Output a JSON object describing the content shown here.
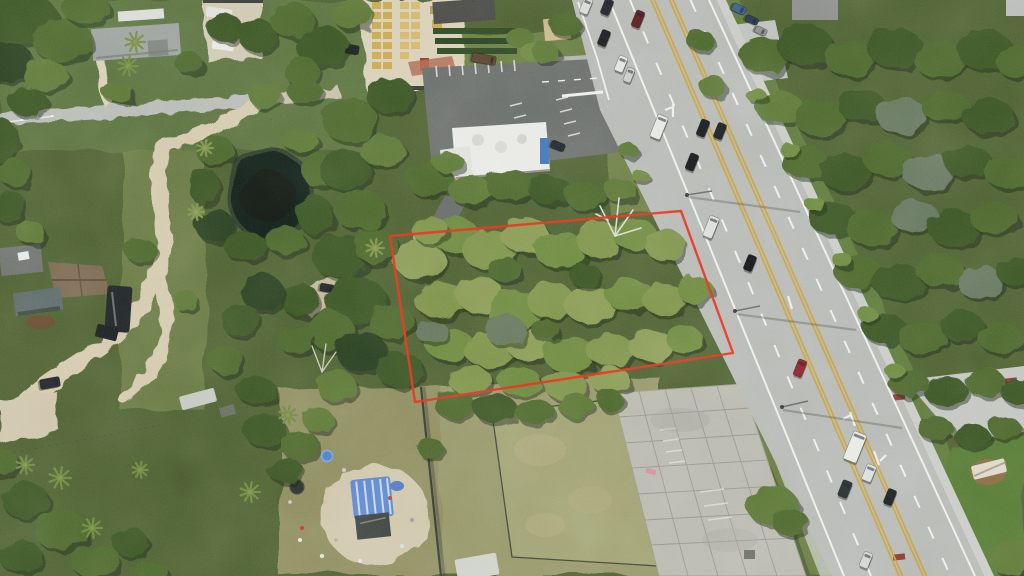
{
  "scene": {
    "description": "Aerial drone photograph of a vacant wooded parcel outlined in red, bordered by a five-lane highway on the east, a pond and rural homes to the west, a commercial parking lot to the north and an old concrete pad to the south",
    "boundary": {
      "points": "390,236 681,211 733,353 415,402",
      "color": "#e8301d",
      "width": 2.4
    },
    "colors": {
      "tree_shades": [
        "#2c4120",
        "#3c5628",
        "#4d682f",
        "#5d7837",
        "#6e8a41",
        "#7e944b",
        "#8a9b55",
        "#66775e"
      ],
      "tree_shadow": "#1b2913",
      "base_forest": "#4f6233",
      "lawn": "#5c7340",
      "lawn_right": "#5e7a3c",
      "lawn_corner": "#567a36",
      "field": "#8f8d60",
      "field_east": "#97976a",
      "mowed_yard": "#a0a273",
      "dirt": "#d3c9ad",
      "sand": "#d8cfb6",
      "gravel": "#cfc9b2",
      "pond": "#19241d",
      "pond_bank": "#31402f",
      "road_asphalt": "#b7b9b5",
      "curb_concrete": "#c9cbc6",
      "lot_asphalt": "#6a6e6b",
      "concrete_pad": "#b9b9af",
      "marking_white": "#eceee9",
      "marking_yellow": "#c8a23c",
      "tarp_blue": "#5a86cf",
      "roof_gray": "#9aa09c",
      "roof_brown": "#7a6850",
      "roof_white": "#e8e9e4"
    },
    "vehicles": [
      [
        586,
        6,
        16,
        9,
        "#d8dad6"
      ],
      [
        607,
        7,
        16,
        9,
        "#23262a"
      ],
      [
        638,
        19,
        17,
        9,
        "#5d2026"
      ],
      [
        604,
        38,
        16,
        9,
        "#1e2124"
      ],
      [
        621,
        64,
        16,
        9,
        "#e2e4e0"
      ],
      [
        629,
        75,
        15,
        8,
        "#c9cbc7"
      ],
      [
        659,
        127,
        24,
        11,
        "#e6e7e3"
      ],
      [
        703,
        128,
        17,
        9,
        "#1b1e21"
      ],
      [
        720,
        131,
        16,
        9,
        "#202327"
      ],
      [
        692,
        162,
        17,
        9,
        "#191c1f"
      ],
      [
        711,
        227,
        22,
        10,
        "#dcdeda"
      ],
      [
        750,
        263,
        16,
        9,
        "#17191c"
      ],
      [
        800,
        368,
        17,
        9,
        "#8e2328"
      ],
      [
        855,
        447,
        30,
        14,
        "#e8e9e5"
      ],
      [
        869,
        473,
        17,
        10,
        "#dcdeda"
      ],
      [
        845,
        489,
        17,
        10,
        "#2a2e31"
      ],
      [
        890,
        497,
        16,
        9,
        "#1d2023"
      ],
      [
        866,
        560,
        16,
        9,
        "#d2d4d0"
      ],
      [
        739,
        9,
        14,
        8,
        "#3e5d8f",
        115
      ],
      [
        752,
        20,
        13,
        7,
        "#2c3a55",
        115
      ],
      [
        761,
        31,
        12,
        7,
        "#8e9290",
        115
      ],
      [
        350,
        49,
        18,
        9,
        "#20241f",
        100
      ],
      [
        484,
        59,
        24,
        9,
        "#5c4632",
        100
      ],
      [
        558,
        146,
        14,
        8,
        "#20262e",
        112
      ],
      [
        50,
        383,
        20,
        10,
        "#23282b",
        80
      ],
      [
        327,
        288,
        14,
        8,
        "#23282b",
        100
      ],
      [
        331,
        316,
        16,
        6,
        "#b9c0bd",
        75
      ]
    ],
    "trees": [
      [
        20,
        18,
        38,
        26,
        1
      ],
      [
        62,
        40,
        30,
        22,
        2
      ],
      [
        8,
        62,
        26,
        20,
        0
      ],
      [
        46,
        76,
        22,
        16,
        3
      ],
      [
        86,
        8,
        24,
        16,
        2
      ],
      [
        28,
        102,
        20,
        14,
        1
      ],
      [
        0,
        140,
        18,
        22,
        1
      ],
      [
        14,
        172,
        16,
        14,
        2
      ],
      [
        8,
        206,
        18,
        16,
        1
      ],
      [
        30,
        232,
        14,
        12,
        3
      ],
      [
        118,
        92,
        16,
        10,
        3
      ],
      [
        188,
        62,
        14,
        10,
        2
      ],
      [
        225,
        28,
        18,
        14,
        1
      ],
      [
        258,
        36,
        20,
        16,
        1
      ],
      [
        292,
        20,
        22,
        18,
        2
      ],
      [
        322,
        46,
        26,
        20,
        1
      ],
      [
        352,
        14,
        20,
        16,
        3
      ],
      [
        302,
        72,
        18,
        14,
        2
      ],
      [
        265,
        96,
        16,
        12,
        3
      ],
      [
        305,
        92,
        18,
        12,
        2
      ],
      [
        565,
        25,
        16,
        12,
        2
      ],
      [
        545,
        52,
        14,
        10,
        3
      ],
      [
        215,
        150,
        20,
        14,
        2
      ],
      [
        204,
        186,
        16,
        18,
        1
      ],
      [
        215,
        226,
        20,
        16,
        0
      ],
      [
        245,
        246,
        22,
        14,
        1
      ],
      [
        285,
        240,
        20,
        14,
        2
      ],
      [
        315,
        215,
        18,
        20,
        1
      ],
      [
        318,
        170,
        16,
        18,
        2
      ],
      [
        300,
        140,
        18,
        12,
        3
      ],
      [
        350,
        120,
        28,
        22,
        2
      ],
      [
        390,
        95,
        24,
        18,
        1
      ],
      [
        345,
        170,
        26,
        20,
        1
      ],
      [
        382,
        150,
        22,
        16,
        3
      ],
      [
        360,
        210,
        26,
        20,
        2
      ],
      [
        340,
        256,
        28,
        22,
        1
      ],
      [
        376,
        246,
        22,
        18,
        2
      ],
      [
        356,
        300,
        30,
        24,
        1
      ],
      [
        330,
        330,
        24,
        20,
        2
      ],
      [
        362,
        352,
        26,
        20,
        0
      ],
      [
        392,
        322,
        22,
        18,
        2
      ],
      [
        400,
        370,
        24,
        18,
        1
      ],
      [
        336,
        386,
        20,
        16,
        3
      ],
      [
        300,
        300,
        20,
        16,
        1
      ],
      [
        296,
        340,
        18,
        14,
        2
      ],
      [
        262,
        292,
        22,
        18,
        0
      ],
      [
        240,
        320,
        20,
        16,
        1
      ],
      [
        226,
        360,
        18,
        14,
        2
      ],
      [
        256,
        390,
        20,
        14,
        1
      ],
      [
        140,
        250,
        16,
        12,
        2
      ],
      [
        185,
        300,
        12,
        10,
        3
      ],
      [
        430,
        180,
        24,
        16,
        2
      ],
      [
        470,
        190,
        22,
        14,
        3
      ],
      [
        510,
        185,
        24,
        16,
        2
      ],
      [
        550,
        190,
        22,
        14,
        1
      ],
      [
        585,
        196,
        20,
        14,
        2
      ],
      [
        620,
        190,
        16,
        12,
        3
      ],
      [
        448,
        162,
        16,
        10,
        3
      ],
      [
        420,
        260,
        26,
        20,
        6
      ],
      [
        455,
        235,
        24,
        18,
        4
      ],
      [
        490,
        250,
        28,
        20,
        5
      ],
      [
        525,
        235,
        24,
        18,
        6
      ],
      [
        560,
        250,
        26,
        18,
        4
      ],
      [
        600,
        240,
        24,
        18,
        5
      ],
      [
        635,
        235,
        22,
        16,
        4
      ],
      [
        665,
        245,
        20,
        16,
        5
      ],
      [
        430,
        230,
        18,
        14,
        5
      ],
      [
        440,
        300,
        26,
        18,
        5
      ],
      [
        480,
        295,
        24,
        18,
        6
      ],
      [
        515,
        310,
        28,
        20,
        4
      ],
      [
        550,
        300,
        24,
        18,
        5
      ],
      [
        590,
        305,
        26,
        18,
        6
      ],
      [
        630,
        295,
        24,
        16,
        4
      ],
      [
        665,
        300,
        22,
        16,
        5
      ],
      [
        695,
        290,
        18,
        14,
        4
      ],
      [
        450,
        345,
        24,
        16,
        4
      ],
      [
        490,
        350,
        26,
        18,
        5
      ],
      [
        530,
        345,
        24,
        16,
        6
      ],
      [
        570,
        355,
        26,
        18,
        4
      ],
      [
        610,
        350,
        24,
        16,
        5
      ],
      [
        650,
        345,
        22,
        16,
        6
      ],
      [
        685,
        340,
        18,
        14,
        4
      ],
      [
        470,
        380,
        22,
        14,
        5
      ],
      [
        520,
        382,
        22,
        14,
        4
      ],
      [
        565,
        385,
        22,
        14,
        5
      ],
      [
        610,
        380,
        20,
        14,
        6
      ],
      [
        505,
        270,
        16,
        12,
        2
      ],
      [
        585,
        275,
        16,
        12,
        1
      ],
      [
        545,
        330,
        14,
        10,
        2
      ],
      [
        505,
        330,
        20,
        16,
        7
      ],
      [
        432,
        332,
        16,
        12,
        7
      ],
      [
        455,
        405,
        20,
        14,
        2
      ],
      [
        495,
        408,
        22,
        14,
        1
      ],
      [
        535,
        412,
        20,
        12,
        2
      ],
      [
        575,
        405,
        18,
        12,
        3
      ],
      [
        610,
        400,
        14,
        10,
        2
      ],
      [
        265,
        430,
        22,
        16,
        1
      ],
      [
        300,
        445,
        20,
        14,
        2
      ],
      [
        285,
        470,
        18,
        12,
        1
      ],
      [
        318,
        420,
        16,
        12,
        3
      ],
      [
        430,
        448,
        13,
        10,
        2
      ],
      [
        765,
        55,
        26,
        18,
        2
      ],
      [
        805,
        45,
        28,
        20,
        1
      ],
      [
        850,
        58,
        26,
        18,
        2
      ],
      [
        895,
        48,
        28,
        20,
        1
      ],
      [
        940,
        60,
        26,
        18,
        2
      ],
      [
        985,
        50,
        28,
        20,
        1
      ],
      [
        1016,
        62,
        20,
        16,
        2
      ],
      [
        700,
        40,
        14,
        10,
        2
      ],
      [
        712,
        86,
        14,
        10,
        3
      ],
      [
        780,
        108,
        24,
        16,
        3
      ],
      [
        820,
        118,
        26,
        18,
        2
      ],
      [
        862,
        106,
        24,
        16,
        1
      ],
      [
        902,
        116,
        26,
        18,
        7
      ],
      [
        945,
        106,
        24,
        16,
        2
      ],
      [
        988,
        116,
        26,
        18,
        1
      ],
      [
        805,
        162,
        24,
        16,
        2
      ],
      [
        845,
        172,
        26,
        18,
        1
      ],
      [
        888,
        160,
        24,
        16,
        2
      ],
      [
        928,
        172,
        26,
        18,
        7
      ],
      [
        968,
        162,
        24,
        16,
        1
      ],
      [
        1008,
        172,
        24,
        16,
        2
      ],
      [
        832,
        218,
        24,
        16,
        1
      ],
      [
        872,
        228,
        26,
        18,
        2
      ],
      [
        914,
        216,
        24,
        16,
        7
      ],
      [
        954,
        228,
        26,
        18,
        1
      ],
      [
        994,
        218,
        24,
        16,
        2
      ],
      [
        858,
        272,
        24,
        16,
        2
      ],
      [
        898,
        282,
        26,
        18,
        1
      ],
      [
        940,
        270,
        24,
        16,
        2
      ],
      [
        980,
        282,
        24,
        16,
        7
      ],
      [
        1016,
        272,
        20,
        14,
        1
      ],
      [
        884,
        328,
        22,
        15,
        1
      ],
      [
        922,
        338,
        24,
        16,
        2
      ],
      [
        962,
        326,
        22,
        15,
        1
      ],
      [
        1000,
        338,
        22,
        15,
        2
      ],
      [
        908,
        382,
        20,
        14,
        2
      ],
      [
        946,
        392,
        22,
        15,
        1
      ],
      [
        985,
        382,
        20,
        14,
        2
      ],
      [
        1018,
        392,
        18,
        12,
        1
      ],
      [
        935,
        428,
        18,
        12,
        2
      ],
      [
        972,
        436,
        18,
        12,
        1
      ],
      [
        1005,
        428,
        16,
        11,
        2
      ],
      [
        756,
        95,
        10,
        7,
        4
      ],
      [
        790,
        150,
        10,
        7,
        4
      ],
      [
        816,
        205,
        10,
        7,
        4
      ],
      [
        842,
        260,
        10,
        7,
        4
      ],
      [
        868,
        315,
        10,
        7,
        4
      ],
      [
        894,
        370,
        10,
        7,
        4
      ],
      [
        628,
        150,
        10,
        7,
        3
      ],
      [
        640,
        176,
        9,
        6,
        4
      ],
      [
        772,
        505,
        26,
        20,
        3
      ],
      [
        790,
        522,
        18,
        14,
        2
      ],
      [
        1012,
        558,
        22,
        18,
        3
      ],
      [
        25,
        500,
        24,
        18,
        1
      ],
      [
        60,
        530,
        26,
        20,
        2
      ],
      [
        20,
        556,
        22,
        16,
        1
      ],
      [
        95,
        562,
        24,
        16,
        2
      ],
      [
        130,
        542,
        18,
        14,
        1
      ],
      [
        0,
        462,
        18,
        14,
        2
      ],
      [
        152,
        572,
        16,
        10,
        2
      ]
    ],
    "palms": [
      [
        25,
        465,
        9,
        4
      ],
      [
        60,
        478,
        11,
        4
      ],
      [
        92,
        528,
        10,
        4
      ],
      [
        250,
        492,
        10,
        4
      ],
      [
        288,
        415,
        9,
        4
      ],
      [
        140,
        470,
        8,
        4
      ],
      [
        196,
        212,
        8,
        5
      ],
      [
        135,
        42,
        10,
        4
      ],
      [
        128,
        66,
        10,
        4
      ],
      [
        205,
        148,
        8,
        5
      ],
      [
        375,
        248,
        9,
        5
      ]
    ]
  }
}
